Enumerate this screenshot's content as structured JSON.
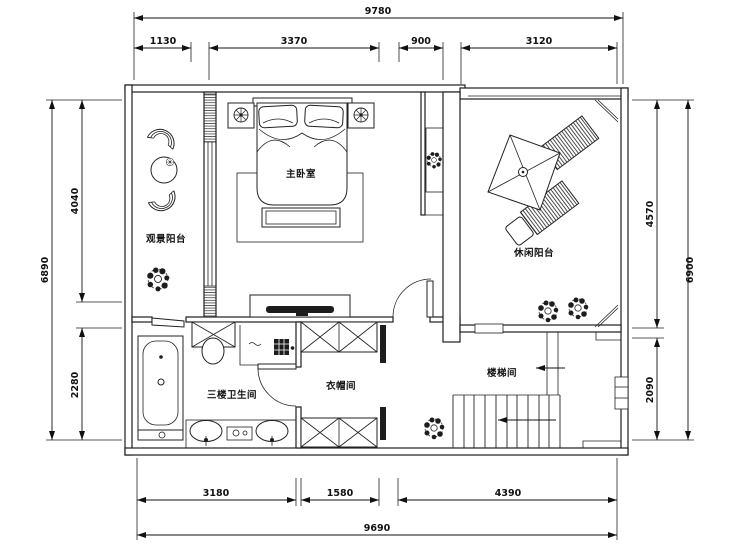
{
  "drawing": {
    "rooms": {
      "master_bedroom": "主卧室",
      "viewing_balcony": "观景阳台",
      "leisure_balcony": "休闲阳台",
      "bathroom_l3": "三楼卫生间",
      "cloakroom": "衣帽间",
      "stairwell": "楼梯间"
    },
    "dims": {
      "top_overall": "9780",
      "top_segments": [
        "1130",
        "3370",
        "900",
        "3120"
      ],
      "bottom_overall": "9690",
      "bottom_segments": [
        "3180",
        "1580",
        "4390"
      ],
      "left_overall": "6890",
      "left_segments": [
        "4040",
        "2280"
      ],
      "right_overall": "6900",
      "right_segments": [
        "4570",
        "2090"
      ]
    },
    "colors": {
      "line": "#1d1d1d",
      "background": "#ffffff"
    }
  }
}
